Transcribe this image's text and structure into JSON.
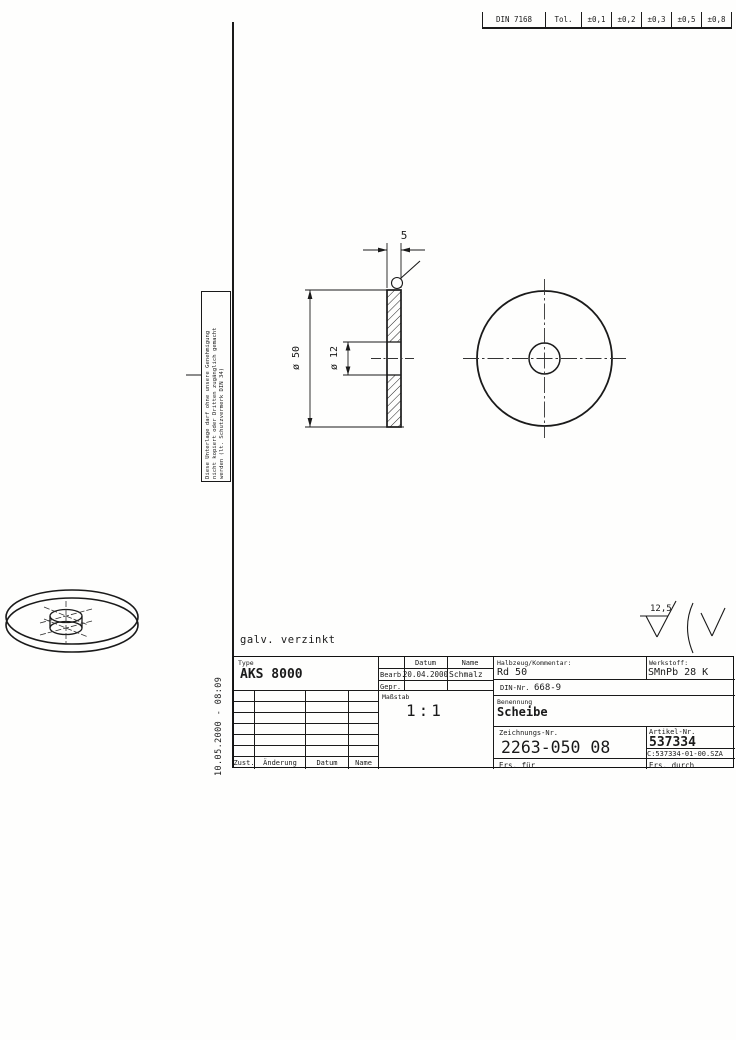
{
  "tolerance_strip": {
    "standard": "DIN 7168",
    "cells": [
      "DIN 7168",
      "Tol.",
      "±0,1",
      "±0,2",
      "±0,3",
      "±0,5",
      "±0,8"
    ]
  },
  "protection_notice": {
    "line1": "Diese Unterlage darf ohne unsere Genehmigung",
    "line2": "nicht kopiert oder Dritten zugänglich gemacht",
    "line3": "werden (lt. Schutzvermerk DIN 34)"
  },
  "drawing": {
    "finish_note": "galv. verzinkt",
    "thickness_dim": "5",
    "outer_diameter_dim": "ø 50",
    "inner_diameter_dim": "ø 12",
    "surface_roughness": "12,5"
  },
  "plot_stamp": "10.05.2000 - 08:09",
  "title_block": {
    "type_label": "Type",
    "type_value": "AKS 8000",
    "revision": {
      "columns": [
        "Zust.",
        "Änderung",
        "Datum",
        "Name"
      ]
    },
    "approval": {
      "datum_header": "Datum",
      "name_header": "Name",
      "bearb_label": "Bearb.",
      "bearb_datum": "20.04.2000",
      "bearb_name": "Schmalz",
      "gepr_label": "Gepr."
    },
    "massstab_label": "Maßstab",
    "massstab_value": "1:1",
    "halbzeug_label": "Halbzeug/Kommentar:",
    "halbzeug_value": "Rd 50",
    "werkstoff_label": "Werkstoff:",
    "werkstoff_value": "SMnPb 28 K",
    "din_label": "DIN-Nr.",
    "din_value": "668-9",
    "benennung_label": "Benennung",
    "benennung_value": "Scheibe",
    "zeichnung_label": "Zeichnungs-Nr.",
    "zeichnung_value": "2263-050 08",
    "artikel_label": "Artikel-Nr.",
    "artikel_value": "537334",
    "artikel_path": "C:537334-01-00.SZA",
    "ers_fuer_label": "Ers. für",
    "ers_durch_label": "Ers. durch"
  }
}
